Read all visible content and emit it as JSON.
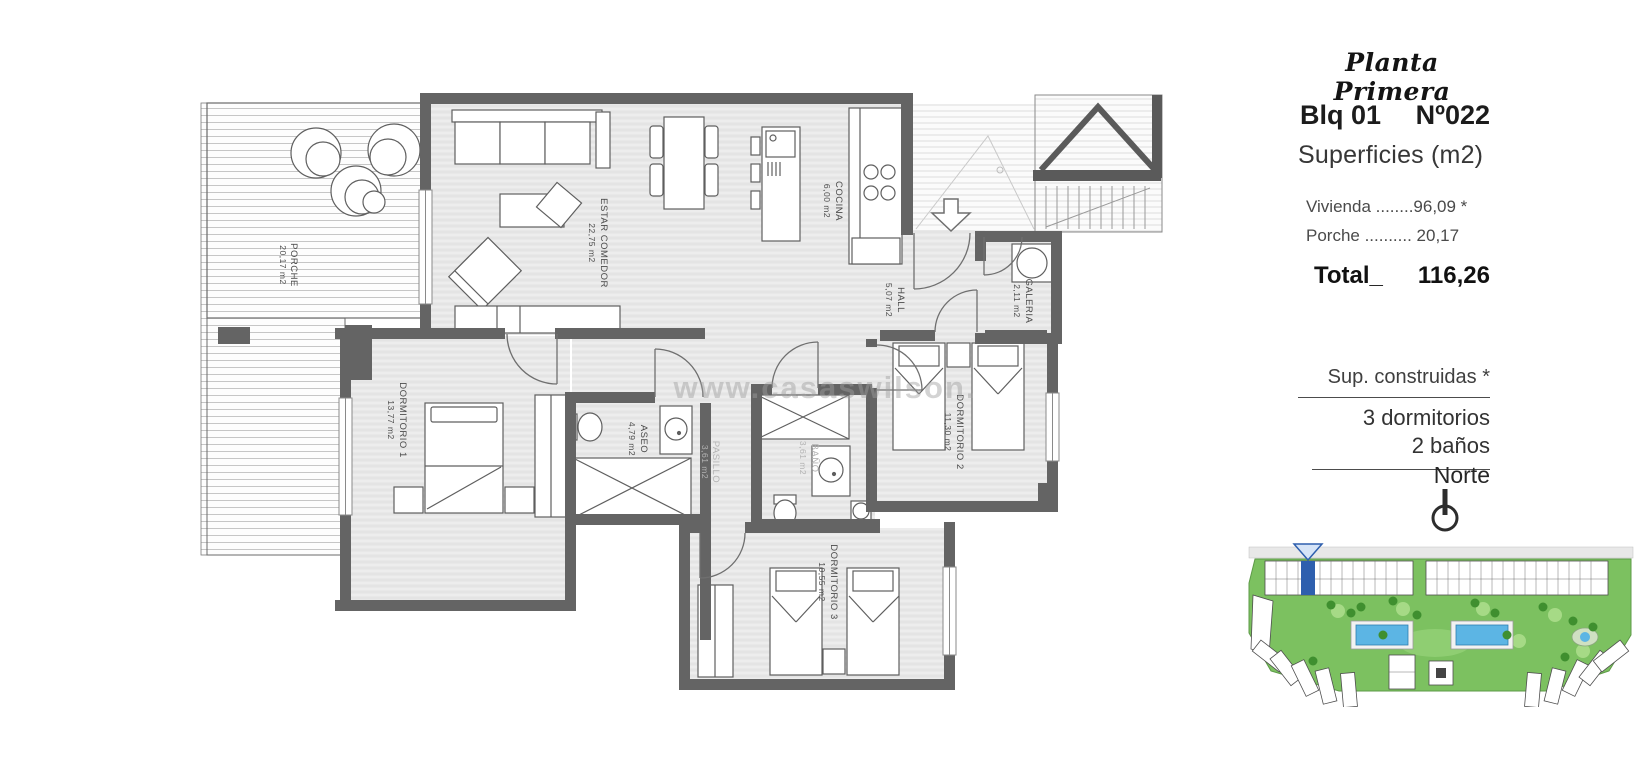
{
  "watermark": "www.casaswilson.",
  "sidebar": {
    "plan_title": "Planta Primera",
    "block_label": "Blq 01",
    "unit_label": "Nº022",
    "surfaces_heading": "Superficies (m2)",
    "surface_rows": [
      "Vivienda ........96,09 *",
      "Porche .......... 20,17"
    ],
    "total_label": "Total_",
    "total_value": "116,26",
    "built_note": "Sup. construidas *",
    "features": [
      "3 dormitorios",
      "2 baños"
    ],
    "north_label": "Norte"
  },
  "rooms": [
    {
      "name": "PORCHE",
      "area": "20,17 m2"
    },
    {
      "name": "ESTAR COMEDOR",
      "area": "22,75 m2"
    },
    {
      "name": "COCINA",
      "area": "6,00 m2"
    },
    {
      "name": "HALL",
      "area": "5,07 m2"
    },
    {
      "name": "GALERIA",
      "area": "2,11 m2"
    },
    {
      "name": "DORMITORIO 1",
      "area": "13,77 m2"
    },
    {
      "name": "ASEO",
      "area": "4,79 m2"
    },
    {
      "name": "PASILLO",
      "area": "3,61 m2"
    },
    {
      "name": "BAÑO",
      "area": "3,61 m2"
    },
    {
      "name": "DORMITORIO 2",
      "area": "11,30 m2"
    },
    {
      "name": "DORMITORIO 3",
      "area": "10,55 m2"
    }
  ]
}
